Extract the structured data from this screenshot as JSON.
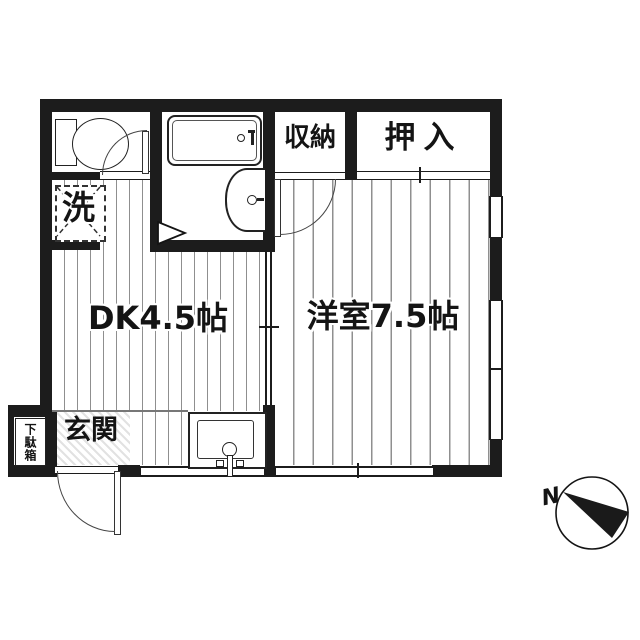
{
  "floorplan": {
    "rooms": {
      "storage_label": "収納",
      "closet_label": "押入",
      "washer_label": "洗",
      "dining_kitchen_label": "DK4.5帖",
      "western_room_label": "洋室7.5帖",
      "entrance_label": "玄関",
      "shoe_cabinet_label": "下駄箱"
    },
    "compass": {
      "north_label": "N"
    },
    "colors": {
      "wall": "#1c1c1c",
      "floor_line": "#8f8f8f",
      "background": "#ffffff",
      "outline": "#222222"
    }
  }
}
